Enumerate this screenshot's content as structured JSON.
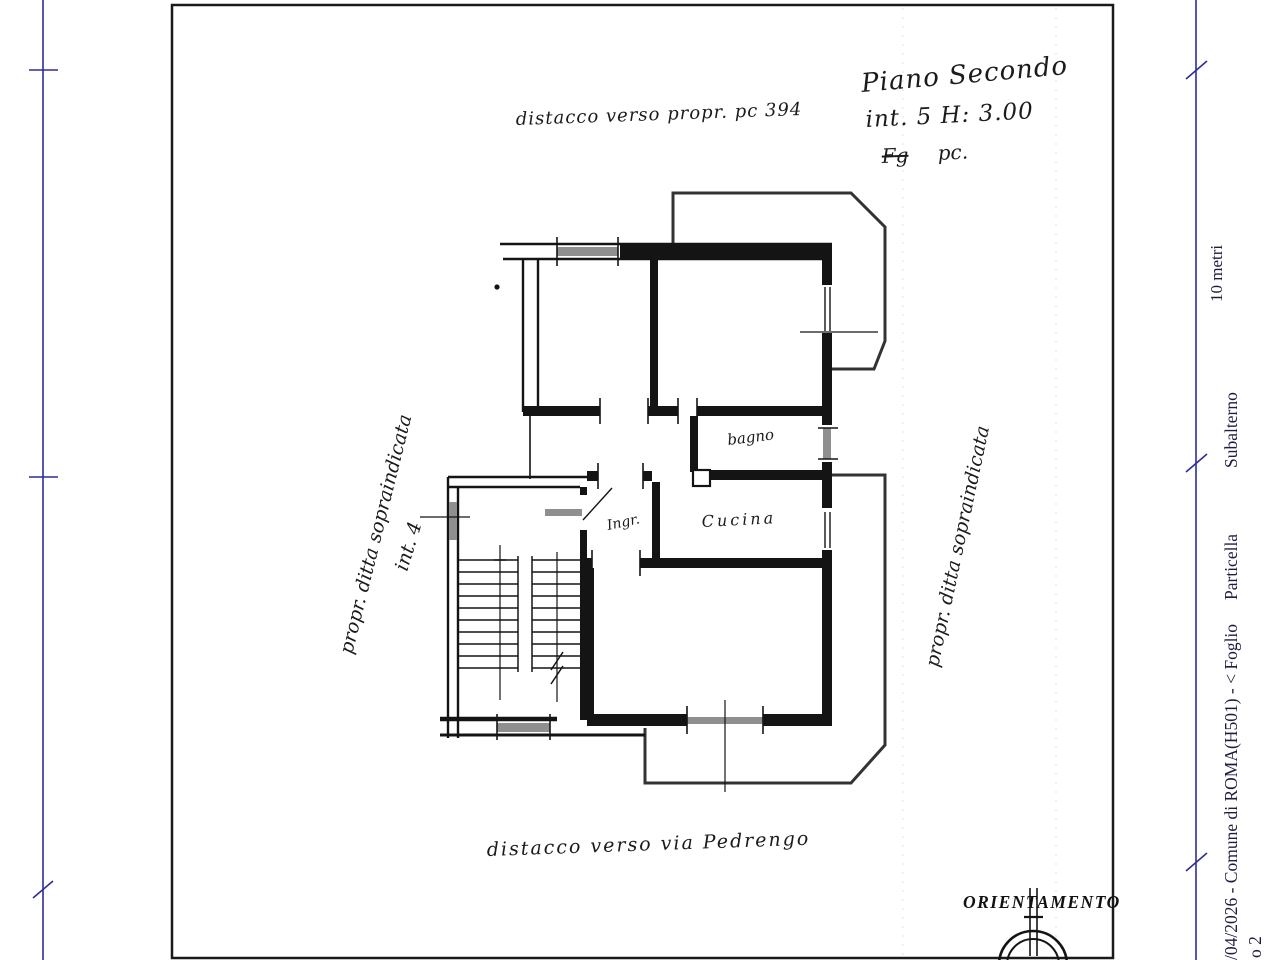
{
  "plan": {
    "title_block": {
      "floor": "Piano Secondo",
      "unit": "int. 5  H: 3.00",
      "fg": "Fg",
      "pc": "pc."
    },
    "annotations": {
      "top": "distacco verso propr. pc 394",
      "bottom": "distacco verso via Pedrengo",
      "left_owner": "propr. ditta sopraindicata",
      "right_owner": "propr. ditta sopraindicata",
      "left_unit": "int. 4"
    },
    "rooms": {
      "bathroom": "bagno",
      "kitchen": "Cucina",
      "entrance": "Ingr."
    },
    "compass_title": "ORIENTAMENTO",
    "scale_label": "10 metri",
    "stamp": {
      "line1": "/04/2026 - Comune di ROMA(H501) - <  Foglio",
      "particella": "Particella",
      "subalterno": "Subalterno",
      "line2_fragment": "o 2"
    },
    "colors": {
      "wall": "#141414",
      "window_fill": "#8f8f8f",
      "balcony_line": "#333333",
      "scale_line": "#2d2d96",
      "stamp_text": "#1d1d40",
      "sheet_border": "#1a1a1a"
    }
  }
}
